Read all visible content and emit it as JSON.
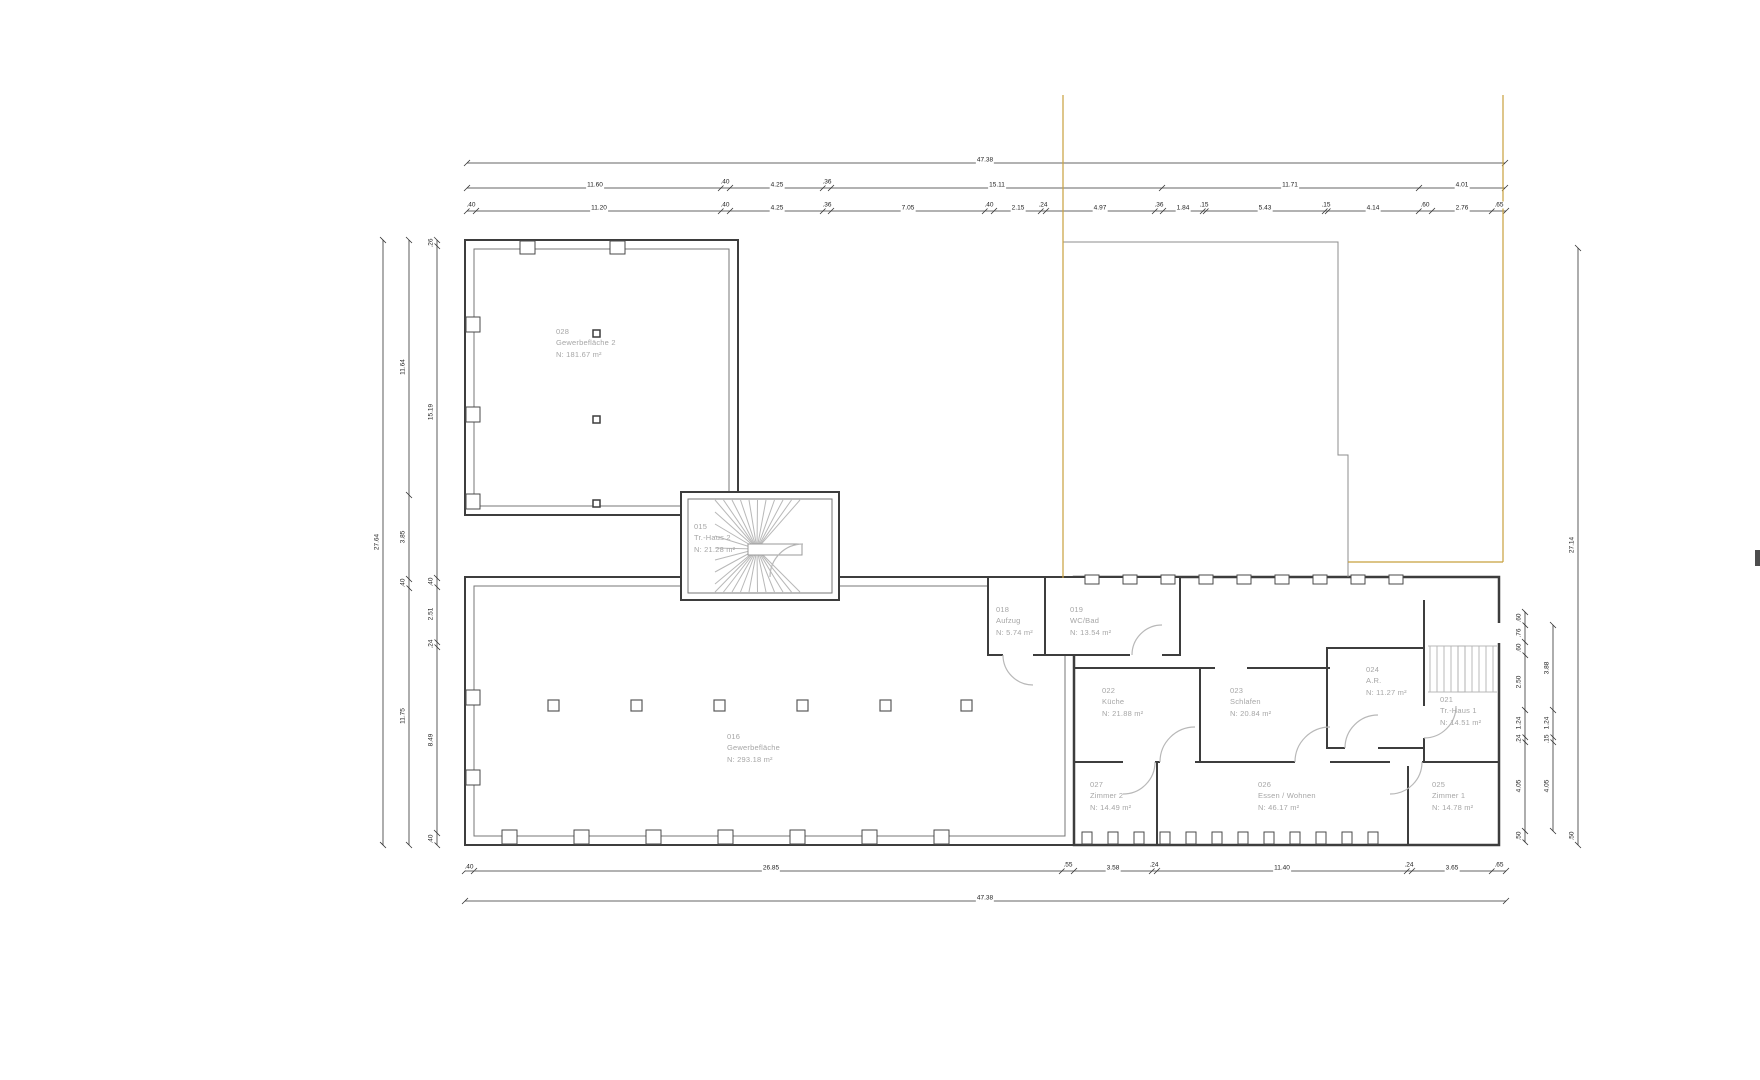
{
  "document": {
    "type": "architectural floor plan",
    "units": "m"
  },
  "colors": {
    "wall": "#3d3d3d",
    "thin_line": "#8c8c8c",
    "room_label": "#a6a6a6",
    "dimension_text": "#222222",
    "reference_line": "#c8a13e",
    "stair_line": "#b8b8b8",
    "background": "#ffffff"
  },
  "rooms": [
    {
      "id": "028",
      "name": "Gewerbefläche 2",
      "area": "N:  181.67  m²",
      "x": 556,
      "y": 326
    },
    {
      "id": "015",
      "name": "Tr.-Haus 2",
      "area": "N:  21.28  m²",
      "x": 694,
      "y": 521
    },
    {
      "id": "018",
      "name": "Aufzug",
      "area": "N:  5.74  m²",
      "x": 996,
      "y": 604
    },
    {
      "id": "019",
      "name": "WC/Bad",
      "area": "N:  13.54  m²",
      "x": 1070,
      "y": 604
    },
    {
      "id": "022",
      "name": "Küche",
      "area": "N:  21.88  m²",
      "x": 1102,
      "y": 685
    },
    {
      "id": "023",
      "name": "Schlafen",
      "area": "N:  20.84  m²",
      "x": 1230,
      "y": 685
    },
    {
      "id": "024",
      "name": "A.R.",
      "area": "N:  11.27  m²",
      "x": 1366,
      "y": 664
    },
    {
      "id": "021",
      "name": "Tr.-Haus 1",
      "area": "N:  14.51  m²",
      "x": 1440,
      "y": 694
    },
    {
      "id": "016",
      "name": "Gewerbefläche",
      "area": "N:  293.18  m²",
      "x": 727,
      "y": 731
    },
    {
      "id": "027",
      "name": "Zimmer 2",
      "area": "N:  14.49  m²",
      "x": 1090,
      "y": 779
    },
    {
      "id": "026",
      "name": "Essen / Wohnen",
      "area": "N:  46.17  m²",
      "x": 1258,
      "y": 779
    },
    {
      "id": "025",
      "name": "Zimmer 1",
      "area": "N:  14.78  m²",
      "x": 1432,
      "y": 779
    }
  ],
  "dimensions": {
    "top": [
      {
        "text": "47.38",
        "x": 985,
        "y": 160
      },
      {
        "text": "11.60",
        "x": 595,
        "y": 185
      },
      {
        "text": ".40",
        "x": 725,
        "y": 182
      },
      {
        "text": "4.25",
        "x": 777,
        "y": 185
      },
      {
        "text": ".36",
        "x": 827,
        "y": 182
      },
      {
        "text": "15.11",
        "x": 997,
        "y": 185
      },
      {
        "text": "11.71",
        "x": 1290,
        "y": 185
      },
      {
        "text": "4.01",
        "x": 1462,
        "y": 185
      },
      {
        "text": ".40",
        "x": 471,
        "y": 205
      },
      {
        "text": "11.20",
        "x": 599,
        "y": 208
      },
      {
        "text": ".40",
        "x": 725,
        "y": 205
      },
      {
        "text": "4.25",
        "x": 777,
        "y": 208
      },
      {
        "text": ".36",
        "x": 827,
        "y": 205
      },
      {
        "text": "7.05",
        "x": 908,
        "y": 208
      },
      {
        "text": ".40",
        "x": 989,
        "y": 205
      },
      {
        "text": "2.15",
        "x": 1018,
        "y": 208
      },
      {
        "text": ".24",
        "x": 1043,
        "y": 205
      },
      {
        "text": "4.97",
        "x": 1100,
        "y": 208
      },
      {
        "text": ".36",
        "x": 1159,
        "y": 205
      },
      {
        "text": "1.84",
        "x": 1183,
        "y": 208
      },
      {
        "text": ".15",
        "x": 1204,
        "y": 205
      },
      {
        "text": "5.43",
        "x": 1265,
        "y": 208
      },
      {
        "text": ".15",
        "x": 1326,
        "y": 205
      },
      {
        "text": "4.14",
        "x": 1373,
        "y": 208
      },
      {
        "text": ".60",
        "x": 1425,
        "y": 205
      },
      {
        "text": "2.76",
        "x": 1462,
        "y": 208
      },
      {
        "text": ".65",
        "x": 1499,
        "y": 205
      }
    ],
    "bottom": [
      {
        "text": ".40",
        "x": 469,
        "y": 867
      },
      {
        "text": "26.85",
        "x": 771,
        "y": 868
      },
      {
        "text": ".55",
        "x": 1068,
        "y": 865
      },
      {
        "text": "3.58",
        "x": 1113,
        "y": 868
      },
      {
        "text": ".24",
        "x": 1154,
        "y": 865
      },
      {
        "text": "11.40",
        "x": 1282,
        "y": 868
      },
      {
        "text": ".24",
        "x": 1409,
        "y": 865
      },
      {
        "text": "3.65",
        "x": 1452,
        "y": 868
      },
      {
        "text": ".65",
        "x": 1499,
        "y": 865
      },
      {
        "text": "47.38",
        "x": 985,
        "y": 898
      }
    ],
    "left": [
      {
        "text": "27.64",
        "x": 377,
        "y": 542,
        "v": 1
      },
      {
        "text": "11.64",
        "x": 403,
        "y": 367,
        "v": 1
      },
      {
        "text": "3.85",
        "x": 403,
        "y": 537,
        "v": 1
      },
      {
        "text": ".40",
        "x": 403,
        "y": 583,
        "v": 1
      },
      {
        "text": "11.75",
        "x": 403,
        "y": 716,
        "v": 1
      },
      {
        "text": ".26",
        "x": 431,
        "y": 243,
        "v": 1
      },
      {
        "text": "15.19",
        "x": 431,
        "y": 412,
        "v": 1
      },
      {
        "text": ".40",
        "x": 431,
        "y": 582,
        "v": 1
      },
      {
        "text": "2.51",
        "x": 431,
        "y": 614,
        "v": 1
      },
      {
        "text": ".24",
        "x": 431,
        "y": 644,
        "v": 1
      },
      {
        "text": "8.49",
        "x": 431,
        "y": 740,
        "v": 1
      },
      {
        "text": ".40",
        "x": 431,
        "y": 839,
        "v": 1
      }
    ],
    "right": [
      {
        "text": ".60",
        "x": 1519,
        "y": 618,
        "v": 1
      },
      {
        "text": ".76",
        "x": 1519,
        "y": 633,
        "v": 1
      },
      {
        "text": ".60",
        "x": 1519,
        "y": 648,
        "v": 1
      },
      {
        "text": "2.50",
        "x": 1519,
        "y": 682,
        "v": 1
      },
      {
        "text": "1.24",
        "x": 1519,
        "y": 723,
        "v": 1
      },
      {
        "text": ".24",
        "x": 1519,
        "y": 739,
        "v": 1
      },
      {
        "text": "4.05",
        "x": 1519,
        "y": 786,
        "v": 1
      },
      {
        "text": ".50",
        "x": 1519,
        "y": 836,
        "v": 1
      },
      {
        "text": "3.88",
        "x": 1547,
        "y": 668,
        "v": 1
      },
      {
        "text": "1.24",
        "x": 1547,
        "y": 723,
        "v": 1
      },
      {
        "text": ".15",
        "x": 1547,
        "y": 739,
        "v": 1
      },
      {
        "text": "4.05",
        "x": 1547,
        "y": 786,
        "v": 1
      },
      {
        "text": ".50",
        "x": 1572,
        "y": 836,
        "v": 1
      },
      {
        "text": "27.14",
        "x": 1572,
        "y": 545,
        "v": 1
      }
    ]
  }
}
